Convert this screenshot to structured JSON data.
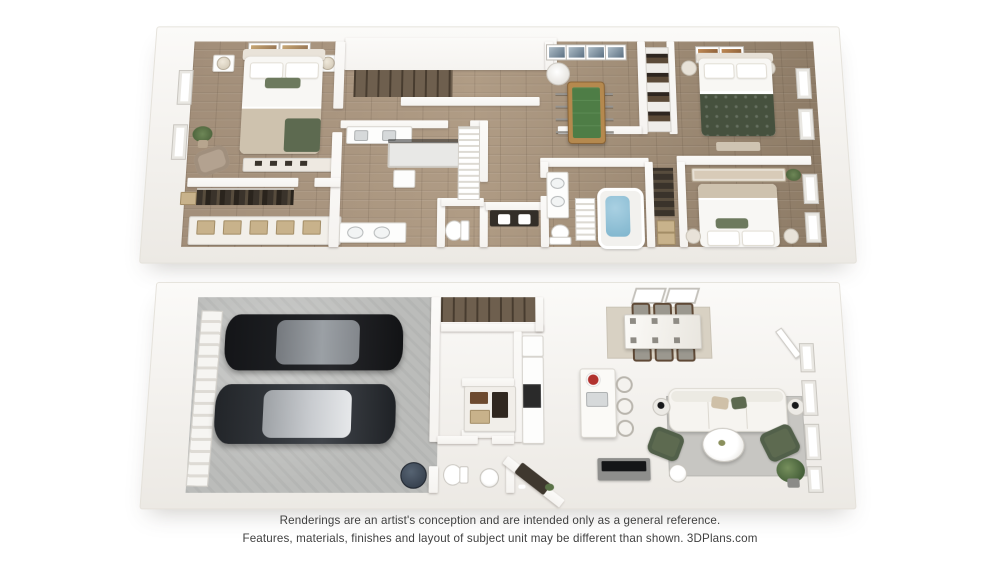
{
  "disclaimer": {
    "line1": "Renderings are an artist's conception and are intended only as a general reference.",
    "line2": "Features, materials, finishes and layout of subject unit may be different than shown. 3DPlans.com"
  },
  "colors": {
    "wall": "#f5f3f0",
    "wood-upper": "#a28e79",
    "wood-lower": "#a7927c",
    "concrete": "#bbbcba",
    "stair": "#6e5f4e",
    "rug-living": "#c7c6c2",
    "rug-dining": "#d8d1c3",
    "green-dark": "#46513e",
    "green-mid": "#5d6a50",
    "green-pillow": "#6d7a5e",
    "tan-blanket": "#cec2ae",
    "tan-box": "#c8b28b",
    "wood-chair": "#5f4936",
    "car-black": "#1d1f22",
    "car-gray": "#33373c",
    "glass-dark": "#9ba0a5",
    "glass-light": "#c9ccd0",
    "water": "#7fb5cd",
    "foos-frame": "#b5894e",
    "foos-field": "#4e7d46",
    "tv": "#141517",
    "console": "#8e8e8c",
    "dark-cloth": "#3a332b",
    "red-accent": "#b1322e",
    "plant": "#5a7247",
    "text": "#3f3f3f"
  }
}
